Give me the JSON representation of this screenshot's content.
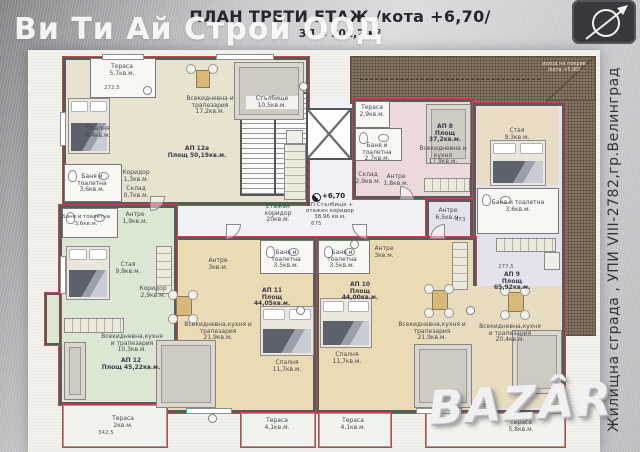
{
  "title": {
    "line1": "ПЛАН ТРЕТИ ЕТАЖ /кота +6,70/",
    "line2": "ЗП = 301,2 м²"
  },
  "watermarks": {
    "company": "Ви Ти Ай Строй ООД",
    "site": "Жилищна сграда , УПИ VIII-2782,гр.Велинград",
    "portal": "BAZÂR"
  },
  "core": {
    "stairs_n": "Стълбище",
    "stairs_a": "10,5кв.м.",
    "corridor_n": "Етажен коридор",
    "corridor_a": "20кв.м.",
    "level": "+6,70",
    "summary_1": "ВП:Стълбище +",
    "summary_2": "етажен коридор",
    "summary_3": "38,96 кв.м."
  },
  "roof": {
    "label_1": "изход на покрив",
    "label_2": "/кота +5,90/"
  },
  "dimensions": {
    "d1": "272,5",
    "d2": "675",
    "d3": "473",
    "d4": "277,5",
    "d5": "150",
    "d6": "342,5"
  },
  "apartments": {
    "ap12a": {
      "name": "АП 12а",
      "area": "Площ 50,19кв.м.",
      "terrace_n": "Тераса",
      "terrace_a": "5,7кв.м.",
      "bedroom_n": "Спалня",
      "bedroom_a": "8,4кв.м.",
      "living_n": "Всекидневна и трапезария",
      "living_a": "17,2кв.м.",
      "bath_n": "Баня и тоалетна",
      "bath_a": "3,6кв.м.",
      "corridor_n": "Коридор",
      "corridor_a": "1,3кв.м.",
      "storage_n": "Склад",
      "storage_a": "0,7кв.м."
    },
    "ap8": {
      "name": "АП 8",
      "area": "Площ 37,2кв.м.",
      "terrace_n": "Тераса",
      "terrace_a": "2,9кв.м.",
      "bath_n": "Баня и тоалетна",
      "bath_a": "2,7кв.м.",
      "storage_n": "Склад",
      "storage_a": "2,9кв.м.",
      "antre_n": "Антре",
      "antre_a": "1,8кв.м.",
      "living_n": "Всекидневна и кухня",
      "living_a": "17,9кв.м."
    },
    "ap9": {
      "name": "АП 9",
      "area": "Площ 65,92кв.м.",
      "room_n": "Стая",
      "room_a": "9,3кв.м.",
      "bath_n": "Баня и тоалетна",
      "bath_a": "3,6кв.м.",
      "antre_n": "Антре",
      "antre_a": "6,5кв.м.",
      "living_n": "Всекидневна,кухня и трапезария",
      "living_a": "20,4кв.м.",
      "terrace_n": "Тераса",
      "terrace_a": "5,8кв.м."
    },
    "ap10": {
      "name": "АП 10",
      "area": "Площ 44,00кв.м.",
      "bath_n": "Баня и тоалетна",
      "bath_a": "3,5кв.м.",
      "antre_n": "Антре",
      "antre_a": "3кв.м.",
      "bedroom_n": "Спалня",
      "bedroom_a": "11,7кв.м.",
      "living_n": "Всекидневна,кухня и трапезария",
      "living_a": "21,9кв.м.",
      "terrace_n": "Тераса",
      "terrace_a": "4,1кв.м."
    },
    "ap11": {
      "name": "АП 11",
      "area": "Площ 44,05кв.м.",
      "bath_n": "Баня и тоалетна",
      "bath_a": "3,5кв.м.",
      "antre_n": "Антре",
      "antre_a": "3кв.м.",
      "bedroom_n": "Спалня",
      "bedroom_a": "11,7кв.м.",
      "living_n": "Всекидневна,кухня и трапезария",
      "living_a": "21,9кв.м.",
      "terrace_n": "Тераса",
      "terrace_a": "4,1кв.м."
    },
    "ap12": {
      "name": "АП 12",
      "area": "Площ 45,22кв.м.",
      "bath_n": "Баня и тоалетна",
      "bath_a": "3,6кв.м.",
      "antre_n": "Антре",
      "antre_a": "1,9кв.м.",
      "room_n": "Стая",
      "room_a": "9,9кв.м.",
      "corridor_n": "Коридор",
      "corridor_a": "2,9кв.м.",
      "living_n": "Всекидневна,кухня и трапезария",
      "living_a": "10,3кв.м.",
      "terrace_n": "Тераса",
      "terrace_a": "2кв.м."
    }
  }
}
